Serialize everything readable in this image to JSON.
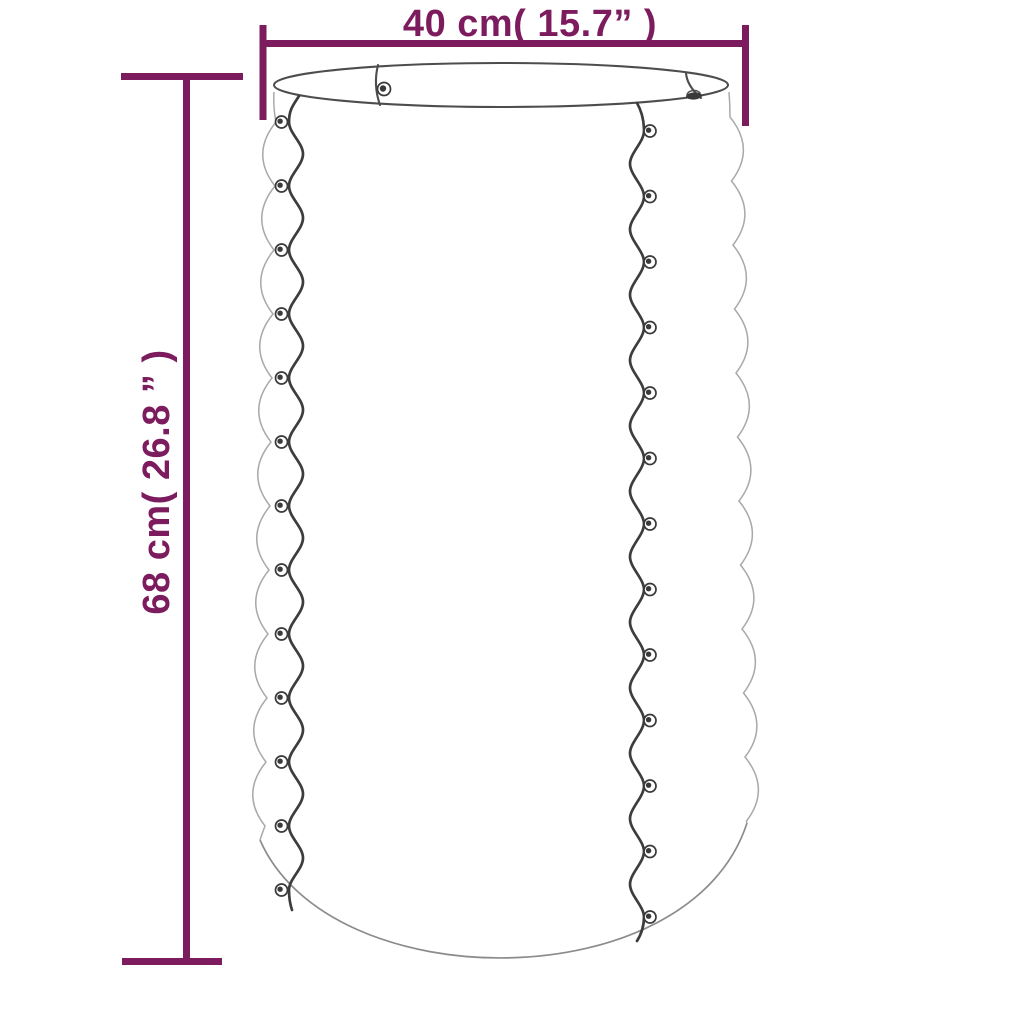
{
  "diagram": {
    "type": "product-dimension-diagram",
    "subject": "corrugated-round-planter",
    "width_dimension_label": "40 cm( 15.7” )",
    "height_dimension_label": "68 cm( 26.8 ” )"
  },
  "colors": {
    "bg": "#ffffff",
    "dim": "#7c1b5d",
    "line_dark": "#3d3d3d",
    "line_mid": "#4d4d4d",
    "line_light": "#a7a9ab",
    "line_bottom": "#8a8c8e",
    "rivet_dark": "#3a3a3a"
  }
}
